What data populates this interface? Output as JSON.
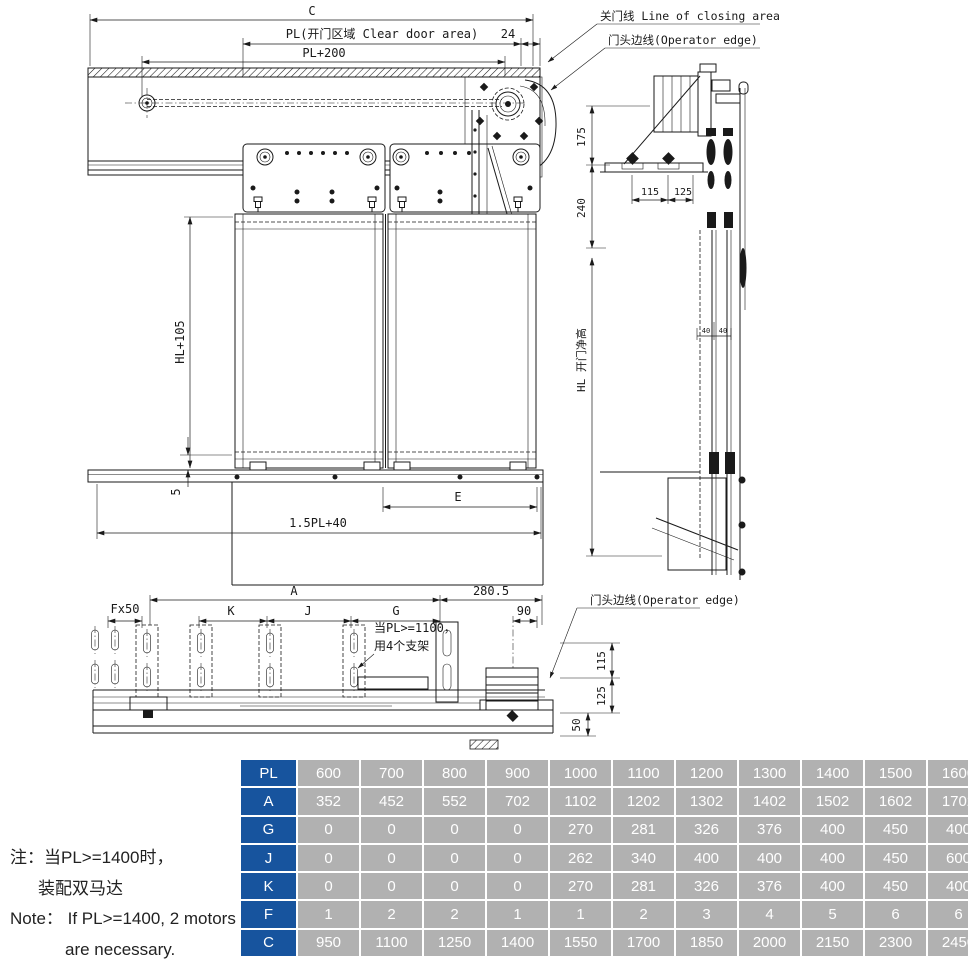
{
  "drawing": {
    "labels": {
      "closing_line": "关门线 Line of closing area",
      "operator_edge_top": "门头边线(Operator edge)",
      "operator_edge_bottom": "门头边线(Operator edge)",
      "support_note_line1": "当PL>=1100，",
      "support_note_line2": "用4个支架"
    },
    "dims": {
      "c": "C",
      "pl_clear": "PL(开门区域 Clear door area)",
      "d24": "24",
      "pl200": "PL+200",
      "hl105": "HL+105",
      "d5": "5",
      "e": "E",
      "pl15_40": "1.5PL+40",
      "a": "A",
      "d280_5": "280.5",
      "fx50": "Fx50",
      "k": "K",
      "j": "J",
      "g": "G",
      "d90": "90",
      "d175": "175",
      "d240": "240",
      "hl_clear": "HL 开门净高",
      "d115": "115",
      "d125": "125",
      "d40": "40",
      "d50": "50"
    }
  },
  "note": {
    "line1": "注：当PL>=1400时，",
    "line2": "装配双马达",
    "line3": "Note： If PL>=1400, 2 motors",
    "line4": "are necessary."
  },
  "table": {
    "header_color": "#17549E",
    "cell_color": "#b1b1b1",
    "rows": [
      {
        "label": "PL",
        "values": [
          "600",
          "700",
          "800",
          "900",
          "1000",
          "1100",
          "1200",
          "1300",
          "1400",
          "1500",
          "1600"
        ]
      },
      {
        "label": "A",
        "values": [
          "352",
          "452",
          "552",
          "702",
          "1102",
          "1202",
          "1302",
          "1402",
          "1502",
          "1602",
          "1702"
        ]
      },
      {
        "label": "G",
        "values": [
          "0",
          "0",
          "0",
          "0",
          "270",
          "281",
          "326",
          "376",
          "400",
          "450",
          "400"
        ]
      },
      {
        "label": "J",
        "values": [
          "0",
          "0",
          "0",
          "0",
          "262",
          "340",
          "400",
          "400",
          "400",
          "450",
          "600"
        ]
      },
      {
        "label": "K",
        "values": [
          "0",
          "0",
          "0",
          "0",
          "270",
          "281",
          "326",
          "376",
          "400",
          "450",
          "400"
        ]
      },
      {
        "label": "F",
        "values": [
          "1",
          "2",
          "2",
          "1",
          "1",
          "2",
          "3",
          "4",
          "5",
          "6",
          "6"
        ]
      },
      {
        "label": "C",
        "values": [
          "950",
          "1100",
          "1250",
          "1400",
          "1550",
          "1700",
          "1850",
          "2000",
          "2150",
          "2300",
          "2450"
        ]
      }
    ]
  }
}
